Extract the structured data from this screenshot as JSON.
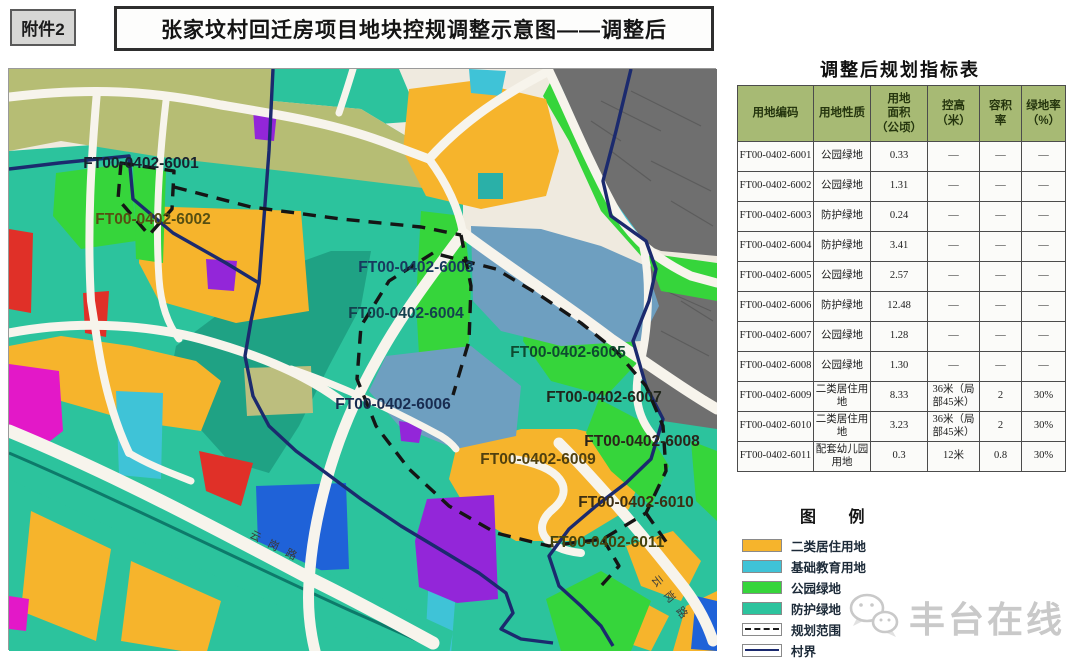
{
  "header": {
    "attachment_label": "附件2",
    "title": "张家坟村回迁房项目地块控规调整示意图——调整后"
  },
  "table": {
    "title": "调整后规划指标表",
    "columns": [
      "用地编码",
      "用地性质",
      "用地\n面积\n（公顷）",
      "控高\n（米）",
      "容积\n率",
      "绿地率\n（%）"
    ],
    "rows": [
      [
        "FT00-0402-6001",
        "公园绿地",
        "0.33",
        "—",
        "—",
        "—"
      ],
      [
        "FT00-0402-6002",
        "公园绿地",
        "1.31",
        "—",
        "—",
        "—"
      ],
      [
        "FT00-0402-6003",
        "防护绿地",
        "0.24",
        "—",
        "—",
        "—"
      ],
      [
        "FT00-0402-6004",
        "防护绿地",
        "3.41",
        "—",
        "—",
        "—"
      ],
      [
        "FT00-0402-6005",
        "公园绿地",
        "2.57",
        "—",
        "—",
        "—"
      ],
      [
        "FT00-0402-6006",
        "防护绿地",
        "12.48",
        "—",
        "—",
        "—"
      ],
      [
        "FT00-0402-6007",
        "公园绿地",
        "1.28",
        "—",
        "—",
        "—"
      ],
      [
        "FT00-0402-6008",
        "公园绿地",
        "1.30",
        "—",
        "—",
        "—"
      ],
      [
        "FT00-0402-6009",
        "二类居住用地",
        "8.33",
        "36米（局部45米）",
        "2",
        "30%"
      ],
      [
        "FT00-0402-6010",
        "二类居住用地",
        "3.23",
        "36米（局部45米）",
        "2",
        "30%"
      ],
      [
        "FT00-0402-6011",
        "配套幼儿园用地",
        "0.3",
        "12米",
        "0.8",
        "30%"
      ]
    ]
  },
  "legend": {
    "title": "图 例",
    "items": [
      {
        "label": "二类居住用地",
        "type": "fill",
        "color": "#f6b42c"
      },
      {
        "label": "基础教育用地",
        "type": "fill",
        "color": "#3fc3d7"
      },
      {
        "label": "公园绿地",
        "type": "fill",
        "color": "#36d53b"
      },
      {
        "label": "防护绿地",
        "type": "fill",
        "color": "#2cc39d"
      },
      {
        "label": "规划范围",
        "type": "dashed",
        "color": "#1a1a1a"
      },
      {
        "label": "村界",
        "type": "solid",
        "color": "#1b2a6e"
      }
    ]
  },
  "map": {
    "parcel_labels": [
      {
        "id": "FT00-0402-6001",
        "x": 140,
        "y": 167,
        "color": "#18222e"
      },
      {
        "id": "FT00-0402-6002",
        "x": 152,
        "y": 223,
        "color": "#564f12"
      },
      {
        "id": "FT00-0402-6003",
        "x": 415,
        "y": 271,
        "color": "#173a5e"
      },
      {
        "id": "FT00-0402-6004",
        "x": 405,
        "y": 317,
        "color": "#14414e"
      },
      {
        "id": "FT00-0402-6005",
        "x": 567,
        "y": 356,
        "color": "#0e4a30"
      },
      {
        "id": "FT00-0402-6006",
        "x": 392,
        "y": 408,
        "color": "#182c50"
      },
      {
        "id": "FT00-0402-6007",
        "x": 603,
        "y": 401,
        "color": "#20261c"
      },
      {
        "id": "FT00-0402-6008",
        "x": 641,
        "y": 445,
        "color": "#2a241a"
      },
      {
        "id": "FT00-0402-6009",
        "x": 537,
        "y": 463,
        "color": "#50400f"
      },
      {
        "id": "FT00-0402-6010",
        "x": 635,
        "y": 506,
        "color": "#3c2e12"
      },
      {
        "id": "FT00-0402-6011",
        "x": 606,
        "y": 546,
        "color": "#44430e"
      }
    ],
    "road_labels": [
      {
        "text": "云岗路",
        "x": 248,
        "y": 536,
        "angle": 27
      },
      {
        "text": "云岗路",
        "x": 650,
        "y": 578,
        "angle": 52
      }
    ]
  },
  "watermark": {
    "text": "丰台在线",
    "icon": "wechat-icon"
  }
}
